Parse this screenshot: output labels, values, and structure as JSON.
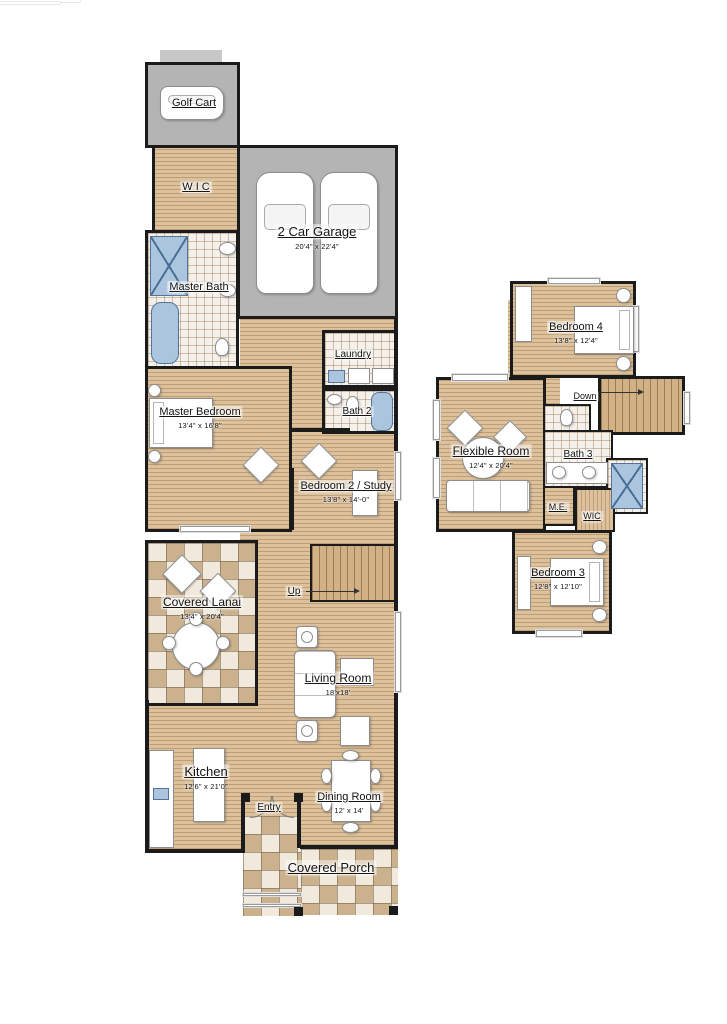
{
  "plan": {
    "floor1": {
      "golf_cart": {
        "label": "Golf Cart"
      },
      "garage": {
        "label": "2 Car Garage",
        "dims": "20'4\" x 22'4\""
      },
      "wic": {
        "label": "W I C"
      },
      "master_bath": {
        "label": "Master Bath"
      },
      "laundry": {
        "label": "Laundry"
      },
      "bath2": {
        "label": "Bath 2"
      },
      "master_bedroom": {
        "label": "Master Bedroom",
        "dims": "13'4\" x 16'8\""
      },
      "bedroom2": {
        "label": "Bedroom 2 / Study",
        "dims": "13'8\" x 14'-0\""
      },
      "stairs_up": {
        "label": "Up"
      },
      "covered_lanai": {
        "label": "Covered Lanai",
        "dims": "13'4\" x 20'4\""
      },
      "living_room": {
        "label": "Living Room",
        "dims": "18'x18'"
      },
      "kitchen": {
        "label": "Kitchen",
        "dims": "12'6\" x 21'0\""
      },
      "entry": {
        "label": "Entry"
      },
      "dining_room": {
        "label": "Dining Room",
        "dims": "12' x 14'"
      },
      "covered_porch": {
        "label": "Covered Porch"
      }
    },
    "floor2": {
      "bedroom4": {
        "label": "Bedroom 4",
        "dims": "13'8\" x 12'4\""
      },
      "stairs_down": {
        "label": "Down"
      },
      "flexible_room": {
        "label": "Flexible Room",
        "dims": "12'4\" x 20'4\""
      },
      "bath3": {
        "label": "Bath 3"
      },
      "me": {
        "label": "M.E."
      },
      "wic2": {
        "label": "WIC"
      },
      "bedroom3": {
        "label": "Bedroom 3",
        "dims": "12'8\" x 12'10\""
      }
    },
    "colors": {
      "wall": "#1b1b1b",
      "wood_floor": "#dcc19c",
      "garage_gray": "#b4b4b4",
      "tile": "#f5f0e9",
      "checker_tan": "#cbb18c",
      "fixture_blue": "#abc5df"
    }
  }
}
